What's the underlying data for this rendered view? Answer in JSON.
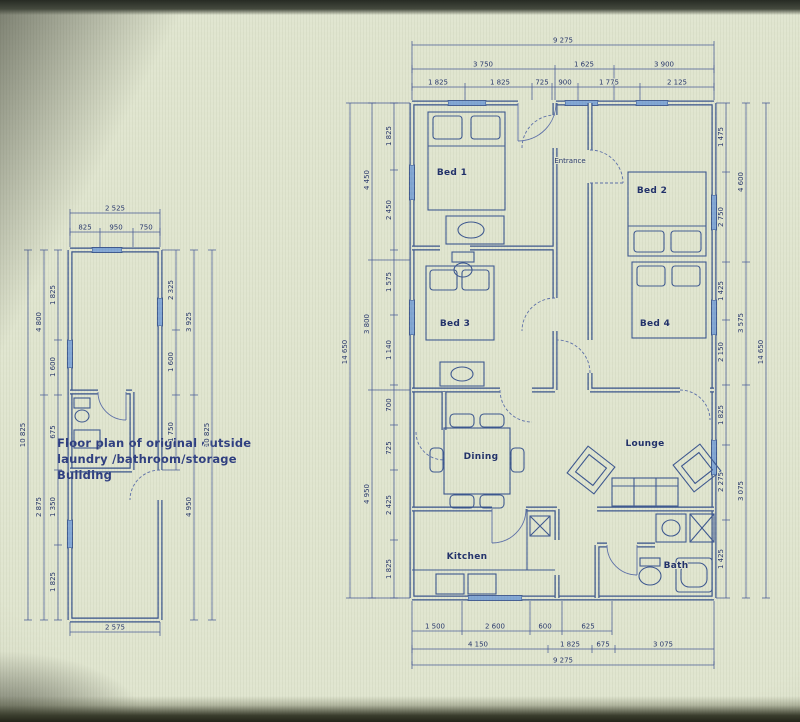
{
  "colors": {
    "paper": "#e0e5cf",
    "ink": "#32508f",
    "window": "#7ea6d8",
    "dim_text": "#24356e"
  },
  "small_plan": {
    "caption_line1": "Floor plan of original  outside",
    "caption_line2": "laundry /bathroom/storage",
    "caption_line3": "Buliding",
    "top_total": "2 525",
    "top_segs": [
      "825",
      "950",
      "750"
    ],
    "bottom_total": "2 575",
    "left_outer": "10 825",
    "left_mid": [
      "4 800",
      "2 875"
    ],
    "left_inner": [
      "1 825",
      "1 600",
      "675",
      "1 350",
      "1 825"
    ],
    "right_inner": [
      "2 325",
      "1 600",
      "1 750"
    ],
    "right_mid": [
      "3 925",
      "4 950"
    ],
    "right_outer": "10 825"
  },
  "main_plan": {
    "rooms": {
      "bed1": "Bed 1",
      "bed2": "Bed 2",
      "bed3": "Bed 3",
      "bed4": "Bed 4",
      "entrance": "Entrance",
      "dining": "Dining",
      "lounge": "Lounge",
      "kitchen": "Kitchen",
      "bath": "Bath"
    },
    "top_total": "9 275",
    "top_row2": [
      "3 750",
      "1 625",
      "3 900"
    ],
    "top_row3": [
      "1 825",
      "1 825",
      "725",
      "900",
      "1 775",
      "2 125"
    ],
    "bottom_row1": [
      "1 500",
      "2 600",
      "600",
      "625"
    ],
    "bottom_row2": [
      "4 150",
      "1 825",
      "675",
      "3 075"
    ],
    "bottom_total": "9 275",
    "left_outer": "14 650",
    "left_mid": [
      "4 450",
      "3 800",
      "4 950"
    ],
    "left_inner": [
      "1 825",
      "2 450",
      "1 575",
      "1 140",
      "700",
      "725",
      "2 425",
      "1 825"
    ],
    "right_inner": [
      "1 475",
      "2 750",
      "1 425",
      "2 150",
      "1 825",
      "2 275",
      "1 425"
    ],
    "right_mid": [
      "4 600",
      "3 575",
      "3 075"
    ],
    "right_outer": "14 650"
  }
}
